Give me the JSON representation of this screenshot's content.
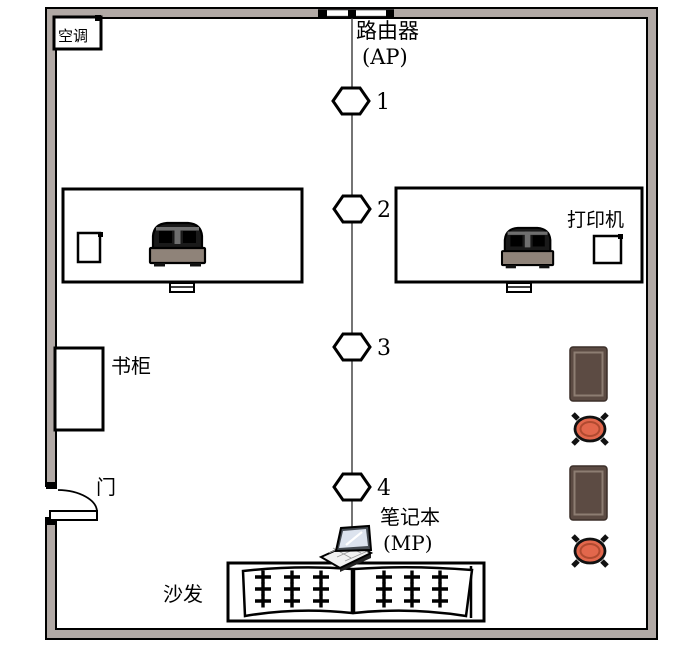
{
  "diagram_title": "room floor plan with wireless AP measurement points",
  "labels": {
    "air_conditioner": "空调",
    "router_line1": "路由器",
    "router_line2": "(AP)",
    "printer": "打印机",
    "bookcase": "书柜",
    "door": "门",
    "laptop_line1": "笔记本",
    "laptop_line2": "(MP)",
    "sofa": "沙发"
  },
  "nodes": [
    "1",
    "2",
    "3",
    "4"
  ],
  "colors": {
    "wall": "#b1a9a5",
    "armchair": "#5c4b43",
    "armchair_border": "#3b2f29",
    "armchair_inner": "#8d7d72",
    "stool": "#e2674c",
    "stool_inner": "#b04a30",
    "monitor_dome": "#1a1a1a",
    "monitor_bar": "#8f8379",
    "line": "#000000"
  }
}
